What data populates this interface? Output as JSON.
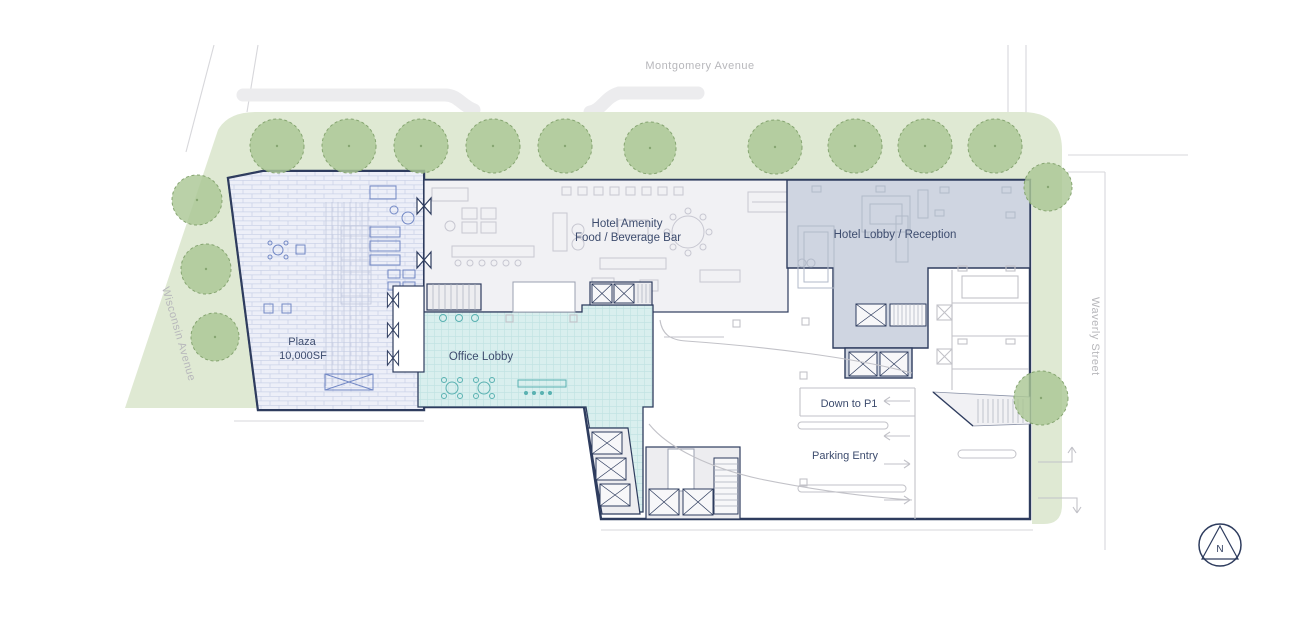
{
  "title": "Ground Floor Site Plan",
  "streets": {
    "top": "Montgomery Avenue",
    "left": "Wisconsin Avenue",
    "right": "Waverly Street"
  },
  "areas": {
    "plaza_name": "Plaza",
    "plaza_size": "10,000SF",
    "amenity_line1": "Hotel Amenity",
    "amenity_line2": "Food / Beverage Bar",
    "hotel_lobby": "Hotel Lobby / Reception",
    "office_lobby": "Office Lobby"
  },
  "parking": {
    "ramp_label": "Down to P1",
    "entry_label": "Parking Entry"
  },
  "compass": {
    "north": "N"
  },
  "colors": {
    "green-band": "#dfe9d3",
    "tree-fill": "#abc795",
    "tree-stroke": "#86a571",
    "navy": "#2e3c5e",
    "navy-text": "#3d4c6e",
    "street-grey": "#d7d7db",
    "street-text": "#b7b7bb",
    "plaza-fill": "#edeff8",
    "plaza-line": "#ccd3e8",
    "plaza-furn": "#7288c5",
    "amenity-fill": "#f1f1f4",
    "furn-grey": "#c7c7d1",
    "lobby-fill": "#cfd5e1",
    "lobby-furn": "#b2bac9",
    "office-fill": "#d9efee",
    "office-grid": "#bfe2e1",
    "office-furn": "#59b1b1",
    "block-fill": "#ededf0",
    "median-fill": "#ececee",
    "arrow-grey": "#c2c2c8"
  }
}
